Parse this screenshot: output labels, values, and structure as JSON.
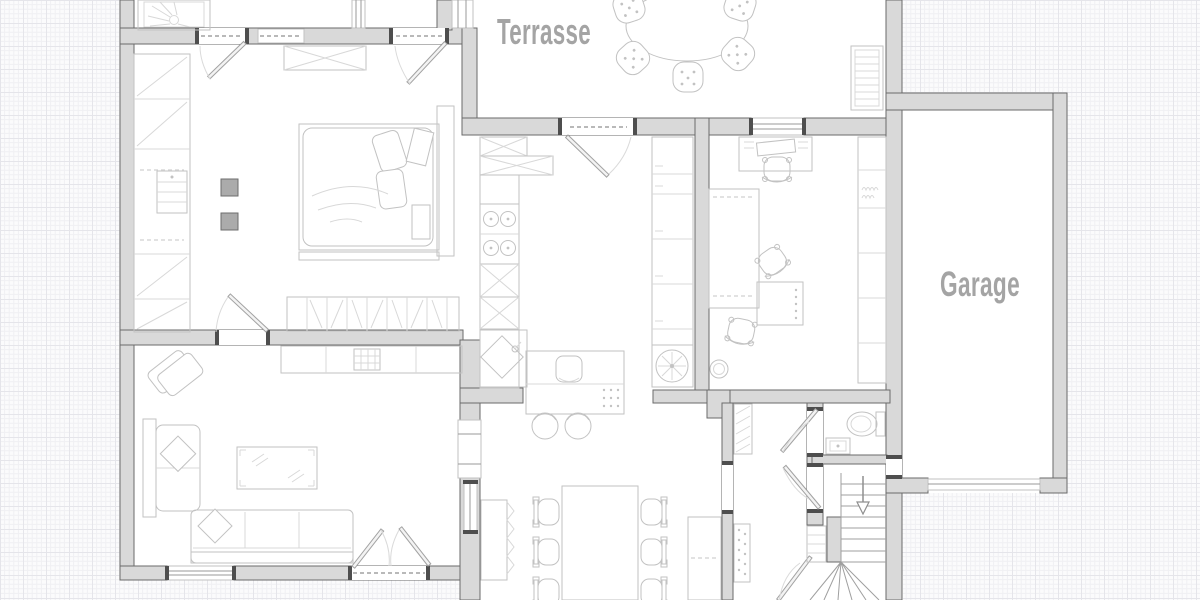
{
  "labels": {
    "terrace": "Terrasse",
    "garage": "Garage"
  },
  "icons": {
    "stair_direction_arrow": "down-arrow"
  },
  "colors": {
    "wall_fill": "#d9d9d9",
    "wall_stroke": "#6a6a6a",
    "post_color": "#4e4e4e",
    "furn_stroke": "#c2c2c2",
    "furn_light": "#d8d8d8",
    "door_stroke": "#a2a2a2",
    "arc_stroke": "#dadada",
    "label_color": "#a4a4a4",
    "accent_square": "#ababab",
    "floor_color": "#ffffff",
    "grid_bg": "#fbfbfc",
    "grid_minor": "#f0f0f3",
    "grid_major": "#e5e5ea"
  }
}
